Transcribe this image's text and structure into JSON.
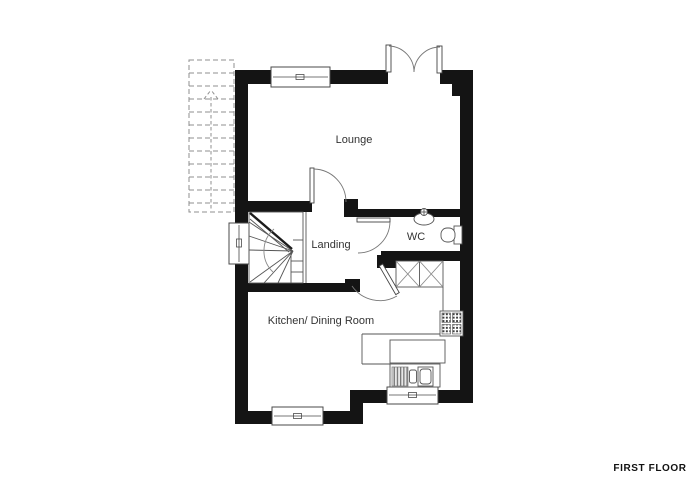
{
  "plan": {
    "rooms": {
      "lounge": "Lounge",
      "landing": "Landing",
      "wc": "WC",
      "kitchen": "Kitchen/ Dining Room"
    },
    "floor_label": "FIRST FLOOR",
    "colors": {
      "wall": "#141414",
      "line": "#555555",
      "text": "#333333",
      "background": "#ffffff"
    },
    "fixtures": [
      "external-stairs-dashed",
      "winder-stairs",
      "french-doors",
      "lounge-door",
      "wc-door",
      "kitchen-door",
      "basin",
      "toilet",
      "storage-units-x",
      "hob",
      "worktop",
      "sink-with-drainer",
      "windows"
    ]
  }
}
